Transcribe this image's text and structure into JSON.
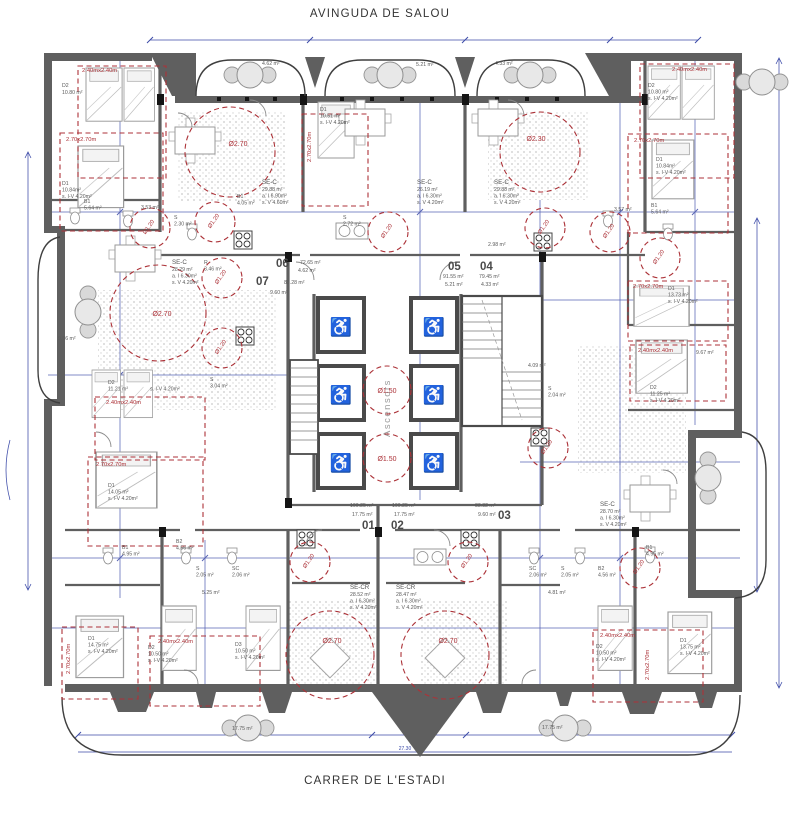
{
  "labels": {
    "street_top": "AVINGUDA DE SALOU",
    "street_bottom": "CARRER DE L'ESTADI"
  },
  "core": {
    "label": "Ascensors"
  },
  "icons": {
    "wheelchair": "♿"
  },
  "units": {
    "u01": {
      "num": "01",
      "area": "100.25 m²",
      "terr": "17.75 m²"
    },
    "u02": {
      "num": "02",
      "area": "100.25 m²",
      "terr": "17.75 m²"
    },
    "u03": {
      "num": "03",
      "area": "83.32 m²",
      "terr": "9.60 m²"
    },
    "u04": {
      "num": "04",
      "area": "79.45 m²",
      "terr": "4.33 m²"
    },
    "u05": {
      "num": "05",
      "area": "91.55 m²",
      "terr": "5.21 m²"
    },
    "u06": {
      "num": "06",
      "area": "72.65 m²",
      "terr": "4.62 m²"
    },
    "u07": {
      "num": "07",
      "area": "83.28 m²",
      "terr": "9.60 m²"
    }
  },
  "living": {
    "sec_tl": {
      "name": "SE-C",
      "area": "29.88 m²",
      "l1": "a. I 6.90m²",
      "l2": "s. V 4.60m²"
    },
    "sec_tc": {
      "name": "SE-C",
      "area": "26.19 m²",
      "l1": "a. I 6.30m²",
      "l2": "s. V 4.20m²"
    },
    "sec_tr": {
      "name": "SE-C",
      "area": "29.88 m²",
      "l1": "a. I 6.30m²",
      "l2": "s. V 4.20m²"
    },
    "sec_ml": {
      "name": "SE-C",
      "area": "28.29 m²",
      "l1": "a. I 6.30m²",
      "l2": "s. V 4.20m²"
    },
    "sec_mr": {
      "name": "SE-C",
      "area": "28.70 m²",
      "l1": "a. I 6.30m²",
      "l2": "s. V 4.20m²"
    },
    "secr_01": {
      "name": "SE-CR",
      "area": "28.52 m²",
      "l1": "a. I 6.30m²",
      "l2": "s. V 4.20m²"
    },
    "secr_02": {
      "name": "SE-CR",
      "area": "28.47 m²",
      "l1": "a. I 6.30m²",
      "l2": "s. V 4.20m²"
    }
  },
  "bed": {
    "d2_tl": {
      "name": "D2",
      "area": "10.80 m²"
    },
    "d1_tl": {
      "name": "D1",
      "area": "10.84m²",
      "vent": "s. I-V 4.20m²"
    },
    "d1_tc": {
      "name": "D1",
      "area": "10.51 m²",
      "vent": "s. I-V 4.20m²"
    },
    "d2_tr": {
      "name": "D2",
      "area": "10.80 m²",
      "vent": "s. I-V 4.20m²"
    },
    "d1_tr": {
      "name": "D1",
      "area": "10.84m²",
      "vent": "s. I-V 4.20m²"
    },
    "d2_ml": {
      "name": "D2",
      "area": "11.21 m²",
      "vent": "s. I-V 4.20m²"
    },
    "d1_ml": {
      "name": "D1",
      "area": "14.05 m²",
      "vent": "s. I-V 4.20m²"
    },
    "d1_r": {
      "name": "D1",
      "area": "13.73 m²",
      "vent": "s. I-V 4.20m²"
    },
    "d2_r": {
      "name": "D2",
      "area": "11.25 m²",
      "vent": "s. I-V 4.20m²"
    },
    "d1_bl": {
      "name": "D1",
      "area": "14.75 m²",
      "vent": "s. I-V 4.20m²"
    },
    "d2_bl": {
      "name": "D2",
      "area": "10.50 m²",
      "vent": "s. I-V 4.20m²"
    },
    "d3_bl": {
      "name": "D3",
      "area": "10.50 m²",
      "vent": "s. I-V 4.20m²"
    },
    "d2_br": {
      "name": "D2",
      "area": "10.50 m²",
      "vent": "s. I-V 4.20m²"
    },
    "d1_br": {
      "name": "D1",
      "area": "13.75 m²",
      "vent": "s. I-V 4.20m²"
    }
  },
  "small": {
    "b1_tl": {
      "name": "B1",
      "area": "5.64 m²"
    },
    "w_tl": {
      "area": "3.53 m²"
    },
    "s_tl": {
      "name": "S",
      "area": "2.30 m²"
    },
    "b1_tc": {
      "name": "B1",
      "area": "4.05 m²"
    },
    "s_tc": {
      "name": "S",
      "area": "2.72 m²"
    },
    "r_ml": {
      "name": "R",
      "area": "3.46 m²"
    },
    "s_ml": {
      "name": "S",
      "area": "3.04 m²"
    },
    "s_tr": {
      "area": "2.98 m²"
    },
    "w_tr": {
      "area": "3.57 m²"
    },
    "b1_tr": {
      "name": "B1",
      "area": "5.64 m²"
    },
    "s_mr": {
      "name": "S",
      "area": "2.04 m²"
    },
    "st_mr": {
      "area": "4.09 m²"
    },
    "b1_bl": {
      "name": "B1",
      "area": "4.95 m²"
    },
    "b2_bl": {
      "name": "B2",
      "area": "4.56 m²"
    },
    "s_bl": {
      "name": "S",
      "area": "2.05 m²"
    },
    "sc_bl": {
      "name": "SC",
      "area": "2.06 m²"
    },
    "sc_br": {
      "name": "SC",
      "area": "2.06 m²"
    },
    "s_br": {
      "name": "S",
      "area": "2.05 m²"
    },
    "b2_br": {
      "name": "B2",
      "area": "4.56 m²"
    },
    "b1_br": {
      "name": "B1",
      "area": "4.95 m²"
    },
    "hall_bl": {
      "area": "5.25 m²"
    },
    "hall_br": {
      "area": "4.81 m²"
    }
  },
  "balc": {
    "t1": "4.62 m²",
    "t2": "5.21 m²",
    "t3": "4.33 m²",
    "left": "9.66 m²",
    "right": "9.67 m²",
    "bl": "17.75 m²",
    "br": "17.75 m²"
  },
  "ann": {
    "c270": "Ø2.70",
    "c230": "Ø2.30",
    "c150": "Ø1.50",
    "c120": "Ø1.20",
    "r240": "2.40mx2.40m",
    "r270": "2.70x2.70m"
  },
  "dims": {
    "d150": "1.50",
    "dtotal": "27.30"
  },
  "colors": {
    "wall": "#5f5f5f",
    "annotation_red": "#ac3238",
    "dimension_blue": "#3b4aa8",
    "paper": "#ffffff"
  }
}
